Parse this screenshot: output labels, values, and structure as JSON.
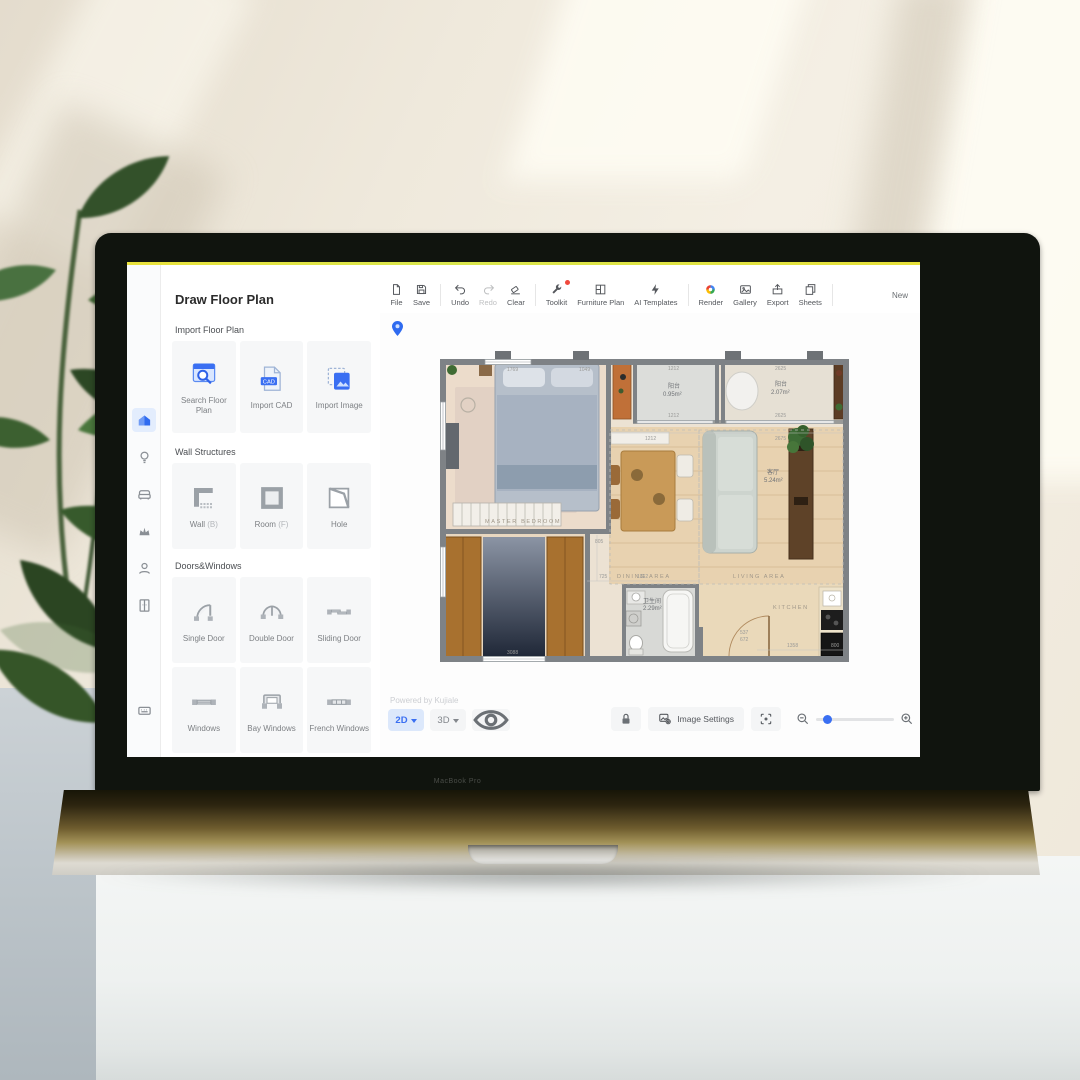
{
  "scene": {
    "laptop_brand": "MacBook Pro"
  },
  "app": {
    "panel": {
      "title": "Draw Floor Plan",
      "cad_badge": "CAD",
      "sections": {
        "import": {
          "title": "Import Floor Plan",
          "items": [
            {
              "label": "Search Floor Plan"
            },
            {
              "label": "Import CAD"
            },
            {
              "label": "Import Image"
            }
          ]
        },
        "walls": {
          "title": "Wall Structures",
          "items": [
            {
              "label": "Wall",
              "hotkey": "(B)"
            },
            {
              "label": "Room",
              "hotkey": "(F)"
            },
            {
              "label": "Hole",
              "hotkey": ""
            }
          ]
        },
        "doors": {
          "title": "Doors&Windows",
          "items": [
            {
              "label": "Single Door"
            },
            {
              "label": "Double Door"
            },
            {
              "label": "Sliding Door"
            },
            {
              "label": "Windows"
            },
            {
              "label": "Bay Windows"
            },
            {
              "label": "French Windows"
            }
          ]
        }
      }
    },
    "toolbar": {
      "items": [
        {
          "label": "File",
          "icon": "file-icon"
        },
        {
          "label": "Save",
          "icon": "save-icon"
        },
        {
          "label": "Undo",
          "icon": "undo-icon"
        },
        {
          "label": "Redo",
          "icon": "redo-icon"
        },
        {
          "label": "Clear",
          "icon": "eraser-icon"
        },
        {
          "label": "Toolkit",
          "icon": "wrench-icon"
        },
        {
          "label": "Furniture Plan",
          "icon": "furniture-plan-icon"
        },
        {
          "label": "AI Templates",
          "icon": "ai-icon"
        },
        {
          "label": "Render",
          "icon": "render-icon"
        },
        {
          "label": "Gallery",
          "icon": "gallery-icon"
        },
        {
          "label": "Export",
          "icon": "export-icon"
        },
        {
          "label": "Sheets",
          "icon": "sheets-icon"
        }
      ],
      "new_label": "New"
    },
    "statusbar": {
      "powered_by": "Powered by Kujiale",
      "view_2d": "2D",
      "view_3d": "3D",
      "image_settings": "Image Settings"
    },
    "colors": {
      "accent": "#3a6ff2",
      "accent_bg": "#dce8fb",
      "toolkit_badge": "#f0483c"
    }
  },
  "floor_plan": {
    "rooms": {
      "master_bedroom": "MASTER BEDROOM",
      "dining_area": "DINING AREA",
      "living_area": "LIVING AREA",
      "kitchen": "KITCHEN",
      "balcony_small_name": "阳台",
      "balcony_small_area": "0.95m²",
      "balcony_large_name": "阳台",
      "balcony_large_area": "2.07m²",
      "bathroom_name": "卫生间",
      "bathroom_area": "2.29m²",
      "living_name": "客厅",
      "living_value": "5.24m²"
    },
    "dims": {
      "d1769": "1769",
      "d1049": "1049",
      "b1_top": "1212",
      "b1_bottom": "1212",
      "b2_top": "2625",
      "b2_bottom": "2625",
      "under_b1": "1212",
      "under_b2": "2675",
      "c805": "805",
      "c725": "725",
      "c1362": "1362",
      "k537": "537",
      "k672": "672",
      "k1358": "1358",
      "k800": "800",
      "w3088": "3088"
    }
  }
}
